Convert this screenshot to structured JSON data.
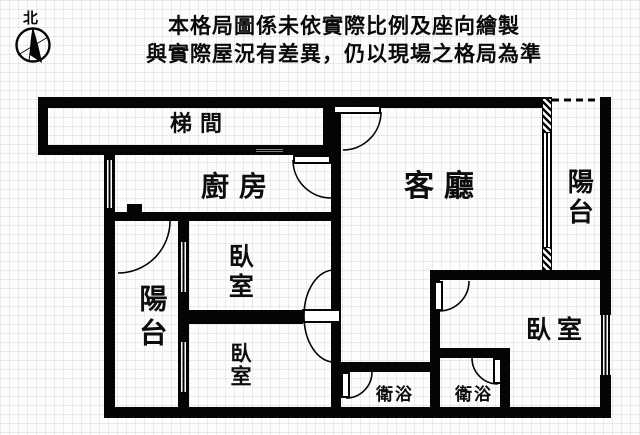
{
  "disclaimer": {
    "line1": "本格局圖係未依實際比例及座向繪製",
    "line2": "與實際屋況有差異，仍以現場之格局為準"
  },
  "compass": {
    "north_label": "北"
  },
  "rooms": {
    "stairwell": {
      "label": "梯間"
    },
    "kitchen": {
      "label": "廚房"
    },
    "living_room": {
      "label": "客廳"
    },
    "balcony_right": {
      "label": "陽台"
    },
    "balcony_left": {
      "label": "陽台"
    },
    "bedroom_middle": {
      "label": "臥室"
    },
    "bedroom_bottom": {
      "label": "臥室"
    },
    "bedroom_right": {
      "label": "臥室"
    },
    "bathroom_left": {
      "label": "衛浴"
    },
    "bathroom_right": {
      "label": "衛浴"
    }
  },
  "colors": {
    "wall": "#050505",
    "background": "#fdfdfd",
    "grid": "#e3e8e4",
    "text": "#0d0d0d"
  }
}
